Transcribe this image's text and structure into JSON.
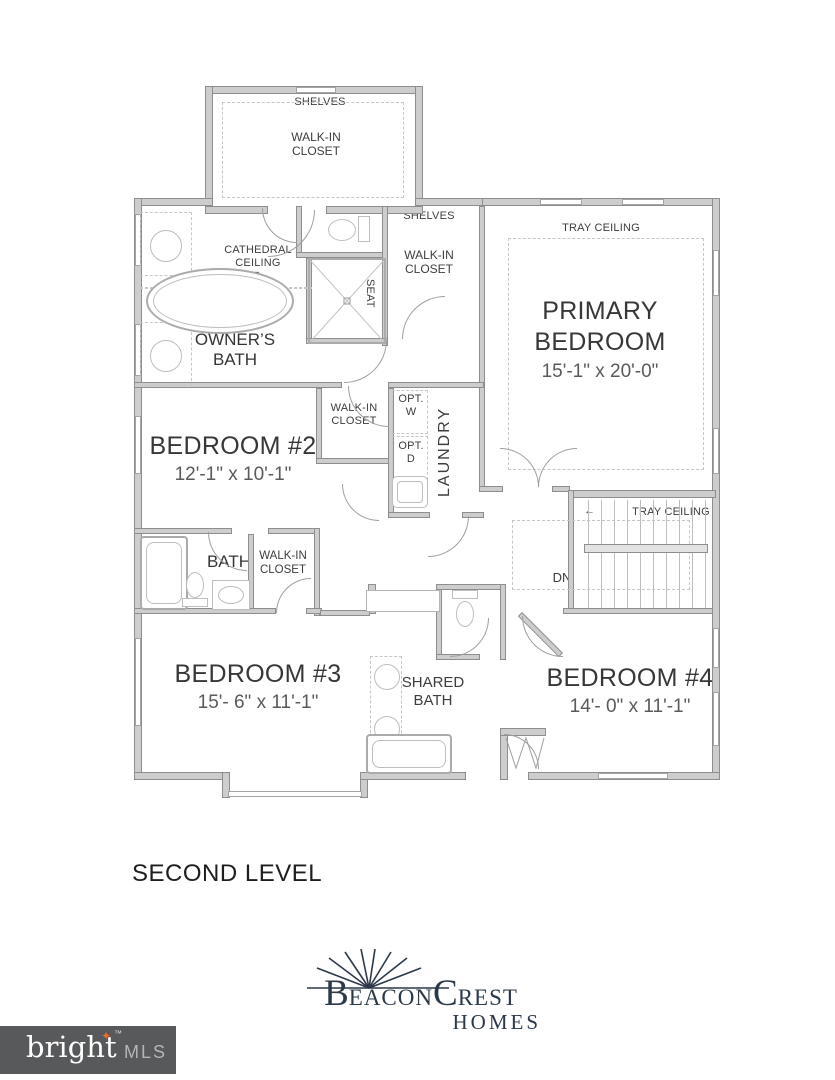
{
  "plan": {
    "level_label": "SECOND LEVEL",
    "rooms": {
      "primary": {
        "name": "PRIMARY BEDROOM",
        "dims": "15'-1\" x 20'-0\""
      },
      "bedroom2": {
        "name": "BEDROOM #2",
        "dims": "12'-1\" x 10'-1\""
      },
      "bedroom3": {
        "name": "BEDROOM #3",
        "dims": "15'- 6\" x 11'-1\""
      },
      "bedroom4": {
        "name": "BEDROOM #4",
        "dims": "14'- 0\" x 11'-1\""
      },
      "owners_bath": {
        "name": "OWNER’S BATH"
      },
      "bath": {
        "name": "BATH"
      },
      "shared_bath": {
        "name": "SHARED BATH"
      },
      "laundry": {
        "name": "LAUNDRY"
      }
    },
    "annotations": {
      "shelves": "SHELVES",
      "walk_in_closet": "WALK-IN CLOSET",
      "cathedral_ceiling": "CATHEDRAL CEILING",
      "free_standing_tub": "FREE STANDING TUB",
      "seat": "SEAT",
      "tray_ceiling": "TRAY CEILING",
      "opt_w": "OPT. W",
      "opt_d": "OPT. D",
      "dn": "DN"
    },
    "icons": {
      "down_arrow": "▼",
      "left_arrow": "←"
    }
  },
  "branding": {
    "logo": {
      "b": "B",
      "eacon": "EACON",
      "c": "C",
      "rest": "REST",
      "homes": "HOMES",
      "color": "#2c3948"
    },
    "watermark": {
      "brand": "bright",
      "tm": "™",
      "suffix": "MLS",
      "bg": "#58595b",
      "star": "✦",
      "star_color": "#ee6a2e"
    }
  }
}
